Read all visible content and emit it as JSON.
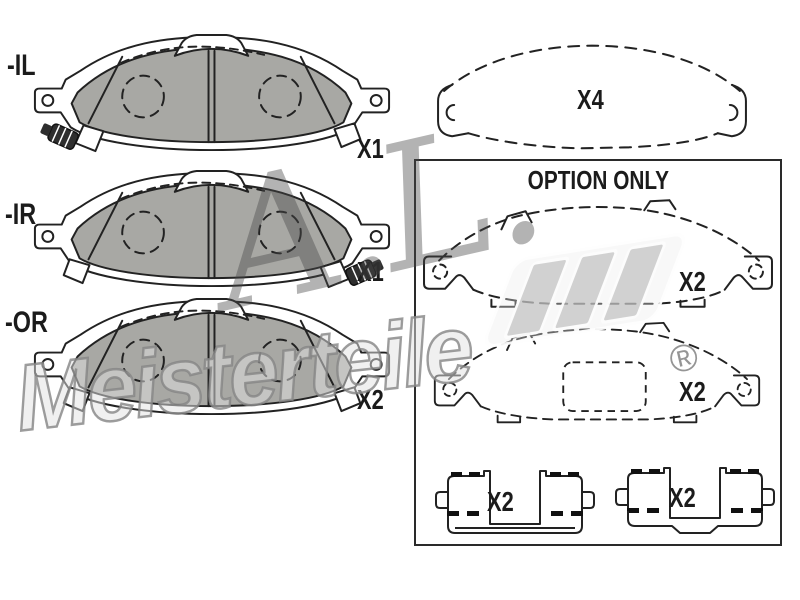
{
  "pads": [
    {
      "id": "il",
      "label": "-IL",
      "qty": "X1"
    },
    {
      "id": "ir",
      "label": "-IR",
      "qty": "X1"
    },
    {
      "id": "or",
      "label": "-OR",
      "qty": "X2"
    }
  ],
  "shim_top": {
    "qty": "X4"
  },
  "option_box": {
    "title": "OPTION ONLY",
    "shims": [
      {
        "qty": "X2"
      },
      {
        "qty": "X2"
      }
    ],
    "clips": [
      {
        "qty": "X2"
      },
      {
        "qty": "X2"
      }
    ]
  },
  "watermark": {
    "script": "A.L.",
    "brand": "Meisterteile",
    "registered": "®"
  },
  "colors": {
    "background": "#ffffff",
    "line": "#222222",
    "friction_gray": "#a8a8a4",
    "option_border": "#2a2a2a",
    "watermark_gray": "#9a9a9a"
  }
}
